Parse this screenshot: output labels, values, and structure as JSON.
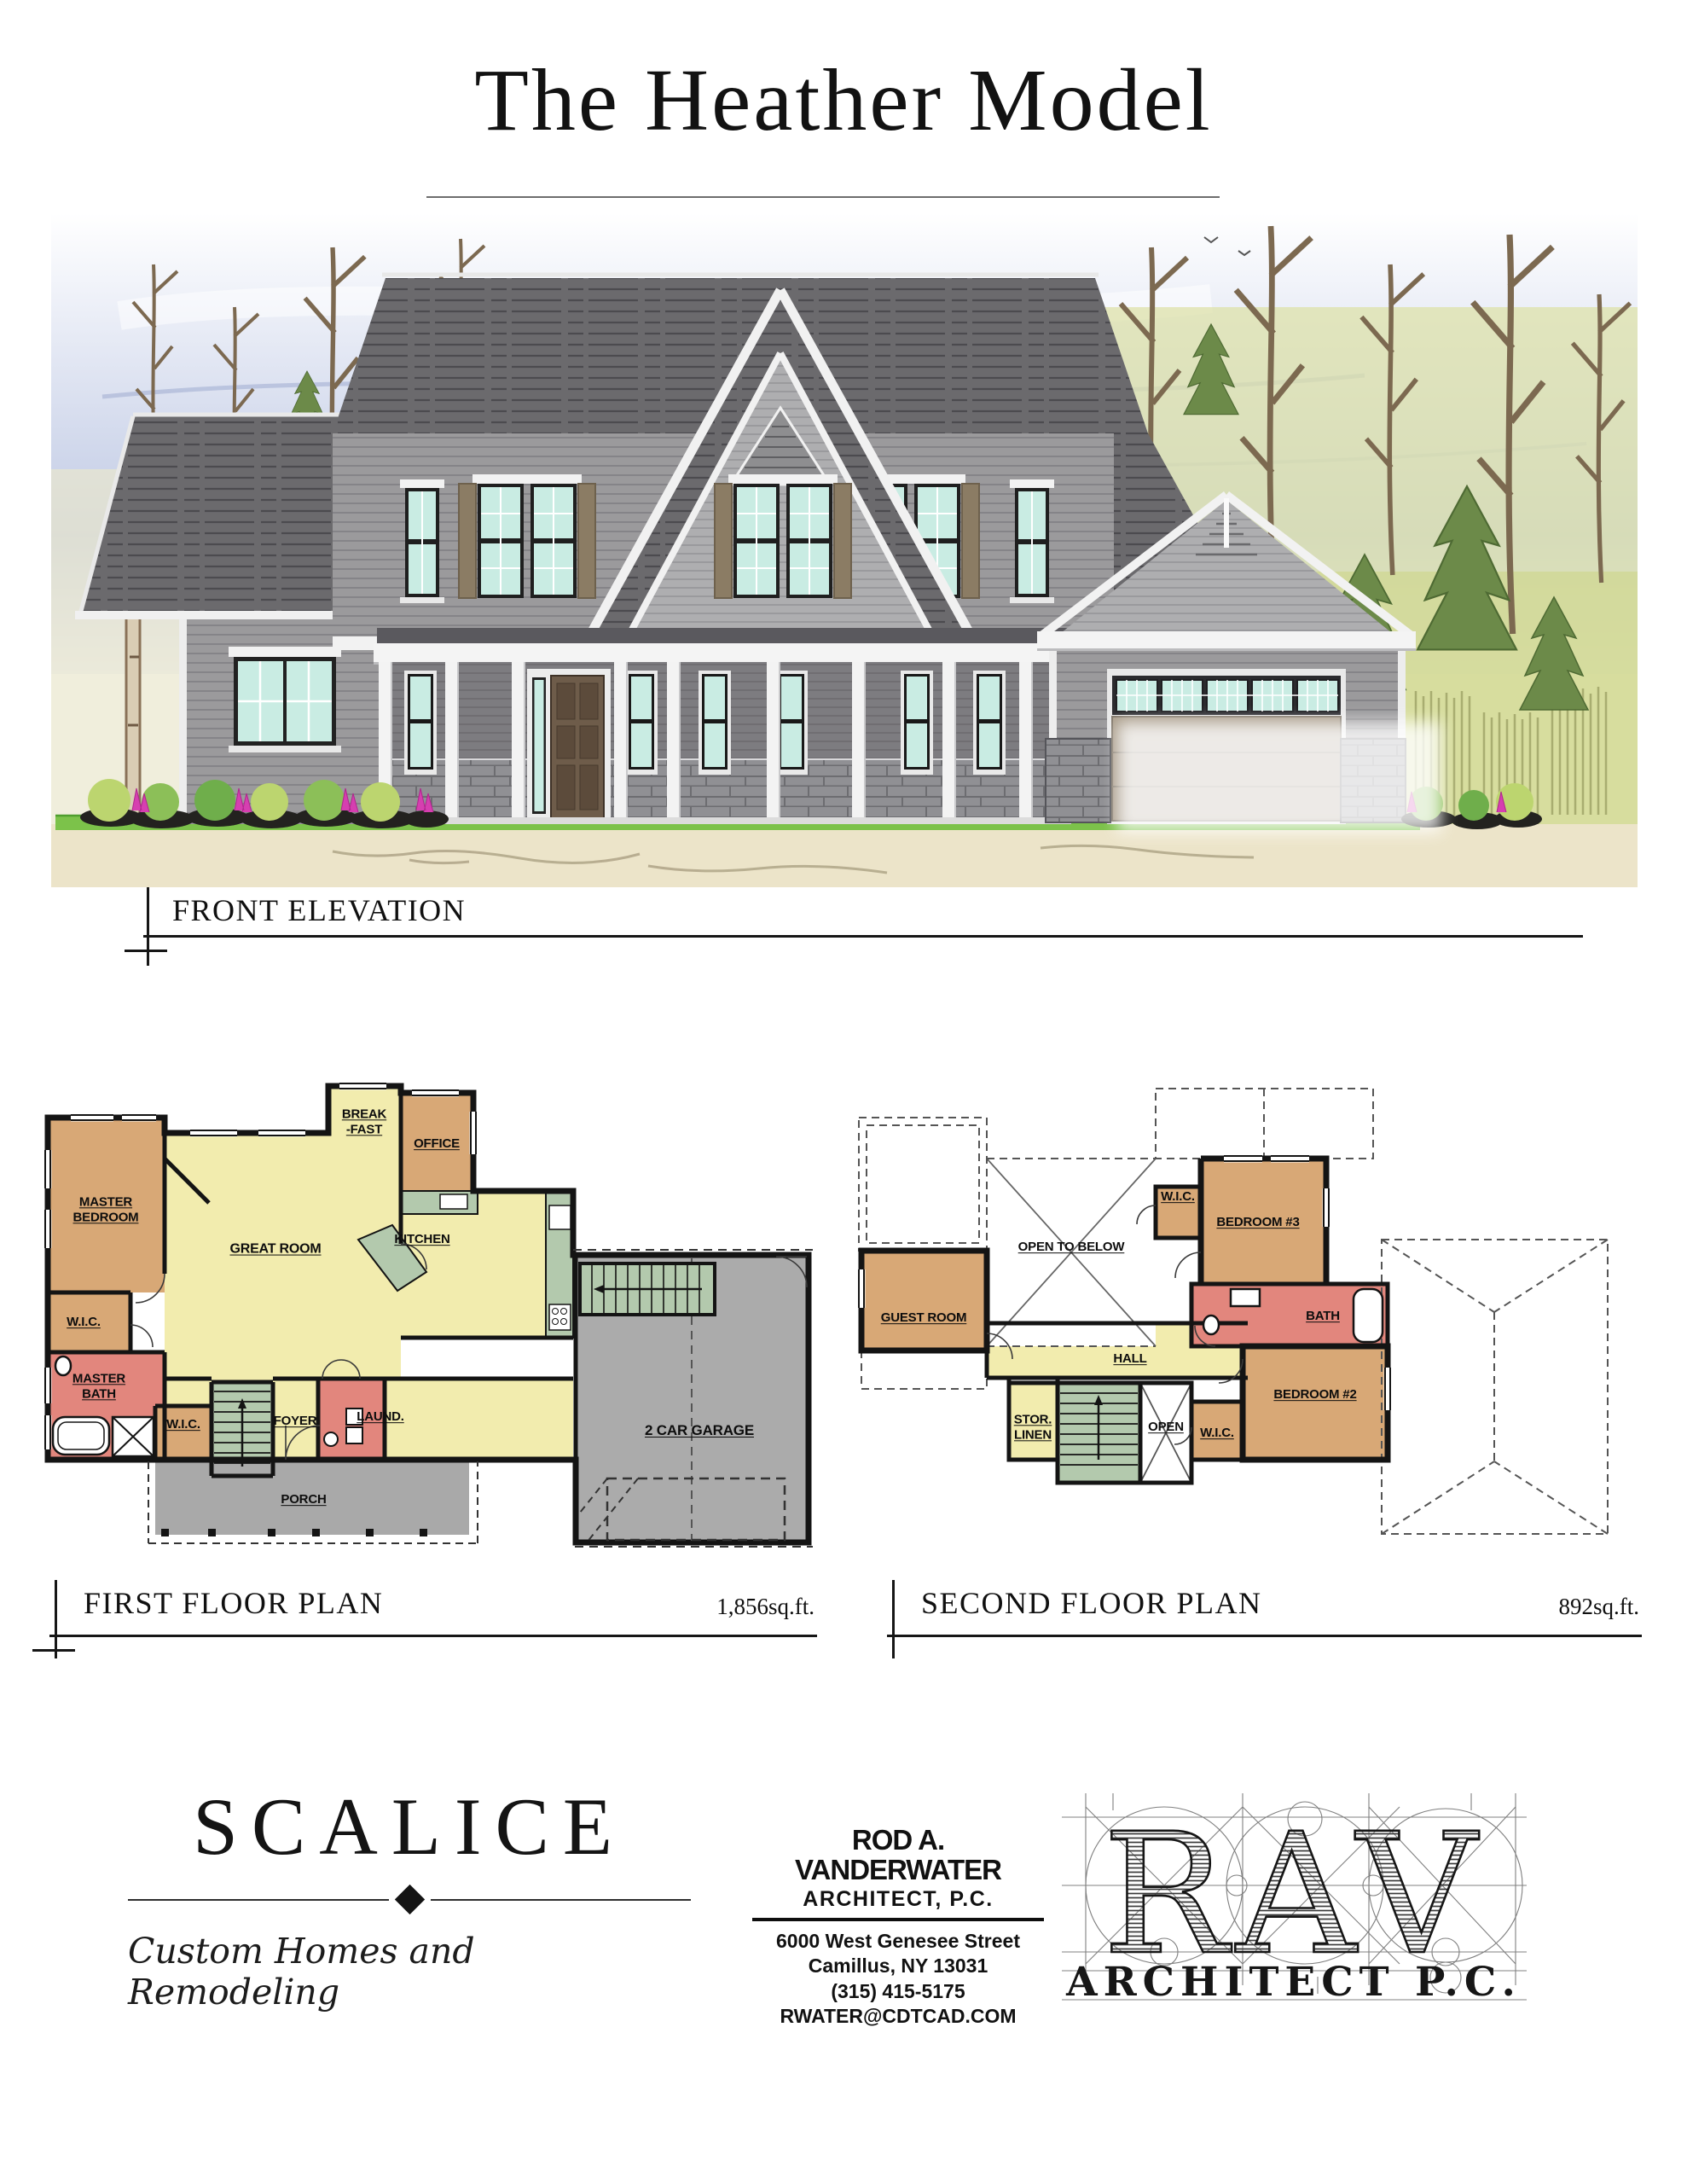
{
  "header": {
    "title": "The Heather Model"
  },
  "elevation": {
    "label": "FRONT ELEVATION"
  },
  "first_floor": {
    "label": "FIRST FLOOR PLAN",
    "area": "1,856sq.ft.",
    "rooms": {
      "master_bedroom": "MASTER\nBEDROOM",
      "wic_master": "W.I.C.",
      "master_bath": "MASTER\nBATH",
      "wic_hall": "W.I.C.",
      "great_room": "GREAT ROOM",
      "breakfast": "BREAK\n-FAST",
      "office": "OFFICE",
      "kitchen": "KITCHEN",
      "foyer": "FOYER",
      "laundry": "LAUND.",
      "porch": "PORCH",
      "garage": "2 CAR GARAGE"
    }
  },
  "second_floor": {
    "label": "SECOND FLOOR PLAN",
    "area": "892sq.ft.",
    "rooms": {
      "guest_room": "GUEST ROOM",
      "open_to_below": "OPEN TO BELOW",
      "wic_bed3": "W.I.C.",
      "bedroom3": "BEDROOM #3",
      "bath": "BATH",
      "hall": "HALL",
      "stor_linen": "STOR.\nLINEN",
      "open_shaft": "OPEN",
      "wic_bed2": "W.I.C.",
      "bedroom2": "BEDROOM #2"
    }
  },
  "branding": {
    "builder": {
      "name": "SCALICE",
      "tagline": "Custom Homes and Remodeling"
    },
    "architect": {
      "name": "ROD A. VANDERWATER",
      "firm": "ARCHITECT, P.C.",
      "address_line1": "6000 West Genesee Street",
      "address_line2": "Camillus, NY 13031",
      "phone": "(315) 415-5175",
      "email": "RWATER@CDTCAD.COM"
    },
    "logo": {
      "letters": "RAV",
      "subtitle": "ARCHITECT P.C."
    }
  },
  "palette": {
    "plan_tan": "#d8a876",
    "plan_yellow": "#f2ecae",
    "plan_pink": "#e2867d",
    "plan_green": "#b3c9ad",
    "plan_porch_gray": "#a9a9a9",
    "plan_garage_gray": "#ababab",
    "wall_black": "#141414",
    "roof_gray": "#6b6a6d",
    "siding_gray": "#9b9a9c",
    "trim_white": "#f4f4f4",
    "glass_mint": "#c9ece3",
    "shutter_tan": "#8b7c64",
    "grass_green": "#7cc24a",
    "ground_cream": "#ece4c9"
  }
}
